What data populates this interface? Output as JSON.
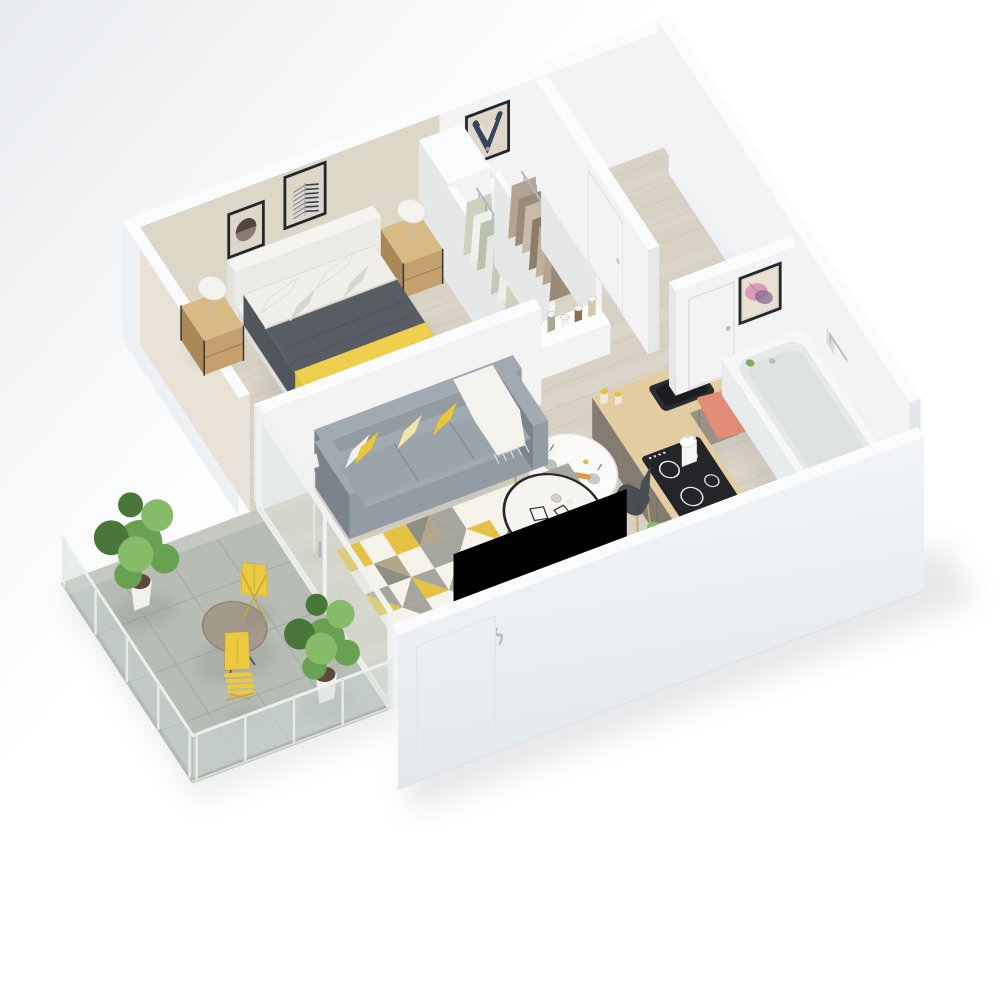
{
  "scene": {
    "name": "apartment-3d-floor-plan",
    "style": "isometric cutaway render, no text labels",
    "background": "#ffffff"
  },
  "palette": {
    "bg": "#ffffff",
    "bgShade": "#e8ebee",
    "floorWood": "#d8d2c5",
    "floorStreak": "#bfb9ab",
    "floorLight": "#e3ddd0",
    "balconyTile": "#b7bcb4",
    "balconyLine": "#9da49b",
    "balconyLight": "#c8ccc4",
    "glass": "#cfdcd8",
    "glassFrame": "#f0f2f2",
    "wallTop": "#fafbfc",
    "wallFace": "#f2f3f2",
    "wallFaceShade": "#e6e8e8",
    "wallOuter": "#eef1f3",
    "wallOuterDeep": "#e2e7eb",
    "bedroomWall": "#ddd7c8",
    "bedroomWallLight": "#e8e3d6",
    "frameDark": "#23262b",
    "matCream": "#ded7c9",
    "artNavy": "#36455e",
    "artBrown": "#8a7b6d",
    "artBrownDark": "#4f473e",
    "artPink": "#d58ab2",
    "artPurple": "#7e6196",
    "artCream": "#e9e1d1",
    "bedWhite": "#f3f2ee",
    "bedWhiteShade": "#dfded8",
    "duvet": "#585c63",
    "duvetDark": "#484c53",
    "throwYellow": "#eecf4e",
    "throwYellowShade": "#ddbc3a",
    "pillowWhite": "#efeee9",
    "pillowGray": "#d6d5d0",
    "woodLight": "#d9ba85",
    "woodMid": "#c4a06e",
    "woodDark": "#ab8858",
    "metal": "#b5bac0",
    "dark": "#34373c",
    "counterWood": "#e3cda1",
    "counterWoodSide": "#d2ba8a",
    "cabinet": "#9a9186",
    "cabinetDark": "#847b71",
    "cabinetLight": "#a89f94",
    "black": "#1d1f22",
    "sofa": "#939ba3",
    "sofaDark": "#7b838c",
    "sofaLight": "#a2aab1",
    "cushionYellow": "#e9c63e",
    "cushionPale": "#efe6ab",
    "cushionWhite": "#f2f0ea",
    "rugBase": "#efeade",
    "rugYellow": "#e5c244",
    "rugGray": "#a7a69e",
    "rugTaupe": "#b2a68b",
    "rugWhite": "#f6f3ea",
    "rugDark": "#8e8d86",
    "tableWhite": "#fafaf8",
    "chairYellow": "#ecc93f",
    "chairDark": "#4a4d53",
    "coral": "#e28e77",
    "tub": "#f6f7f7",
    "tubInner": "#e6e9e8",
    "plantGreen": "#69a152",
    "plantDark": "#49773a",
    "plantLight": "#86bb68",
    "potWhite": "#f1f2f0",
    "shadow": "#5a5f64"
  },
  "rooms": [
    {
      "name": "bedroom",
      "furniture": [
        "double-bed",
        "gray-duvet",
        "yellow-throw",
        "pillows",
        "headboard",
        "nightstand-left",
        "nightstand-right",
        "table-lamp-left",
        "table-lamp-right",
        "artwork-circle",
        "artwork-chevron",
        "floor-lamp"
      ]
    },
    {
      "name": "wc",
      "furniture": [
        "toilet",
        "artwork-v",
        "thermostat",
        "tall-wardrobe"
      ]
    },
    {
      "name": "closet",
      "furniture": [
        "clothes-rack-sage",
        "clothes-rack-taupe",
        "hanging-rods",
        "storage-shelf",
        "jars"
      ]
    },
    {
      "name": "hallway",
      "furniture": [
        "hall-door",
        "bathroom-door"
      ]
    },
    {
      "name": "bathroom",
      "furniture": [
        "bathtub",
        "coral-bath-mat",
        "artwork-abstract",
        "towel-holder"
      ]
    },
    {
      "name": "kitchen",
      "furniture": [
        "l-shaped-counter",
        "black-sink",
        "faucet",
        "induction-cooktop",
        "white-kettle",
        "taupe-cabinets",
        "counter-jars"
      ]
    },
    {
      "name": "dining-area",
      "furniture": [
        "round-pedestal-table",
        "yellow-eames-chair",
        "dark-eames-chair",
        "plates",
        "baguette",
        "cutlery"
      ]
    },
    {
      "name": "living-room",
      "furniture": [
        "gray-sofa",
        "yellow-cushions",
        "white-throw",
        "triangle-rug",
        "round-coffee-table",
        "wire-decor",
        "tv-panel",
        "small-plant",
        "glass-sliding-door"
      ]
    },
    {
      "name": "balcony",
      "furniture": [
        "bistro-table",
        "folding-chair-1",
        "folding-chair-2",
        "potted-plant-large",
        "potted-plant-small",
        "glass-railing",
        "concrete-tiles"
      ]
    }
  ],
  "counts": {
    "sofa_cushions": 4,
    "bed_pillows": 4,
    "closet_garments": 14,
    "cooktop_rings": 4,
    "balcony_plants": 2,
    "framed_artworks": 4
  }
}
